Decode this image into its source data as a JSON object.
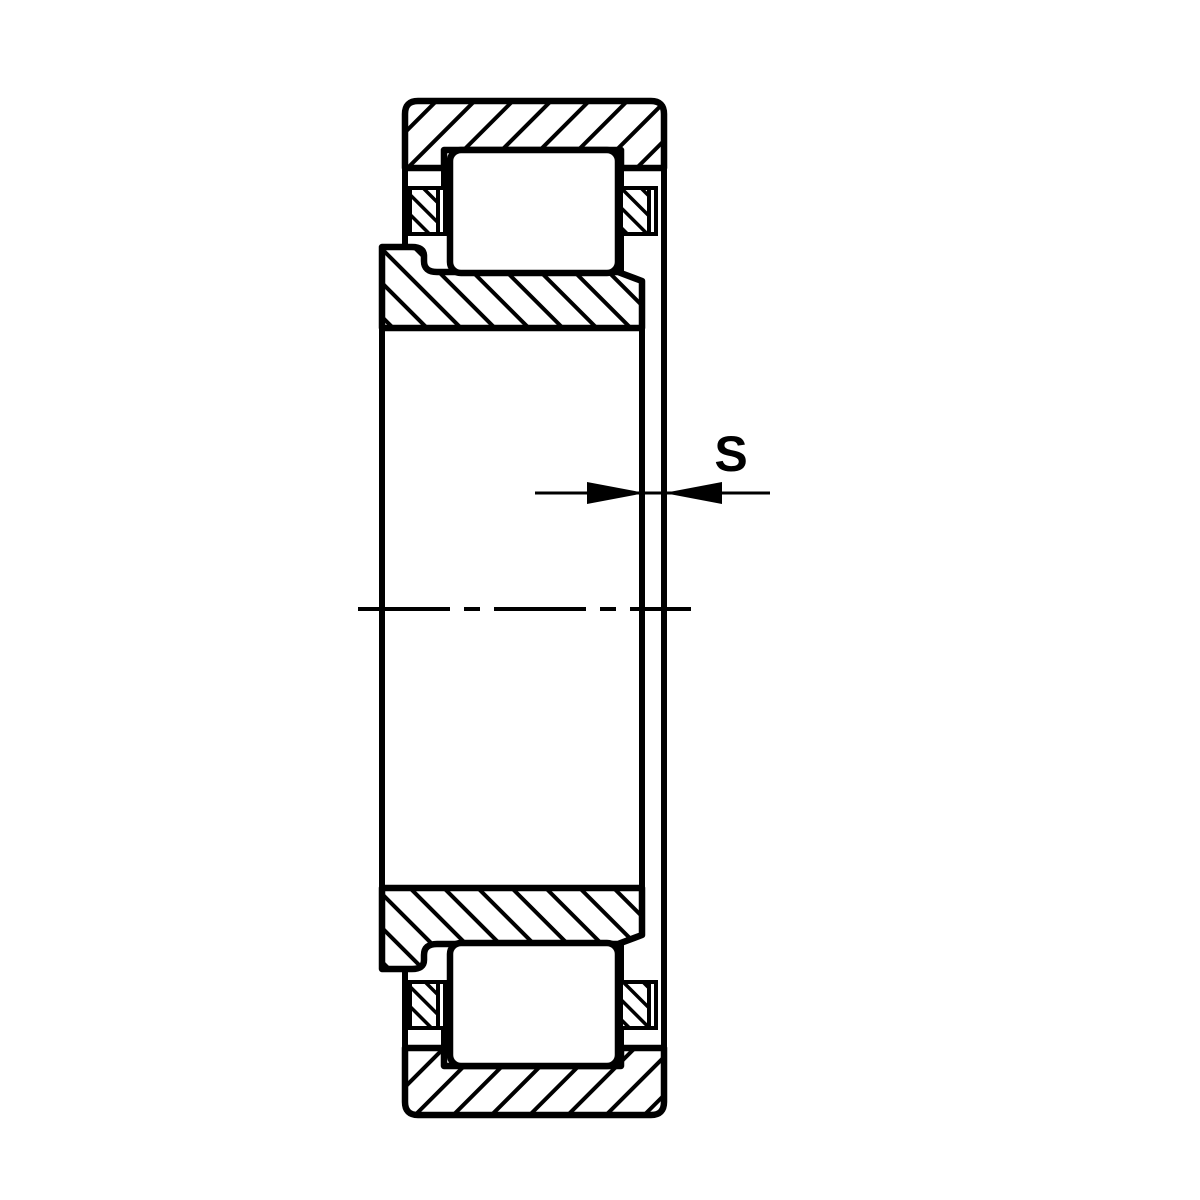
{
  "diagram": {
    "kind": "cylindrical-roller-bearing-cross-section",
    "dimension": {
      "label": "S",
      "meaning": "axial-displacement-gap"
    },
    "colors": {
      "line": "#000000",
      "background": "#ffffff"
    },
    "hatching": {
      "outer_ring_direction": "forward-slash",
      "inner_ring_direction": "back-slash",
      "cage_direction": "back-slash"
    }
  }
}
